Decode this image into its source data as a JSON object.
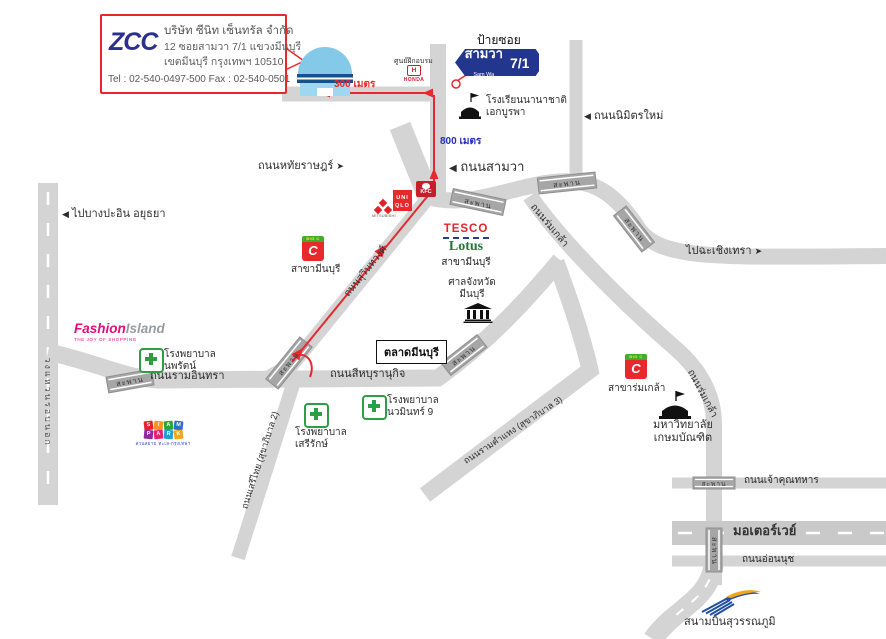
{
  "company_box": {
    "logo": "ZCC",
    "name": "บริษัท ซีนิท เซ็นทรัล จำกัด",
    "address1": "12 ซอยสามวา 7/1 แขวงมีนบุรี",
    "address2": "เขตมีนบุรี กรุงเทพฯ 10510",
    "contact": "Tel : 02-540-0497-500 Fax : 02-540-0501"
  },
  "soi_sign": {
    "caption": "ป้ายซอย",
    "name": "สามวา",
    "name_en": "Sam Wa",
    "number": "7/1"
  },
  "route": {
    "d300": "300 เมตร",
    "d800": "800 เมตร"
  },
  "icons": {
    "arrow_left": "◀",
    "arrow_right": "➤"
  },
  "roads": {
    "sam_wa": "ถนนสามวา",
    "nimit_mai": "ถนนนิมิตรใหม่",
    "hathai_rat": "ถนนหทัยราษฎร์",
    "ram_inthra": "ถนนรามอินทรา",
    "sihaburanukit": "ถนนสีหบุรานุกิจ",
    "suwinthawong": "ถนนสุวินทวงศ์",
    "rom_klao": "ถนนร่มเกล้า",
    "seri_thai": "ถนนเสรีไทย (สุขาภิบาล 2)",
    "ramkhamhaeng": "ถนนรามคำแหง (สุขาภิบาล 3)",
    "ring_road": "วงแหวนรอบนอก",
    "motorway": "มอเตอร์เวย์",
    "chao_khun_thahan": "ถนนเจ้าคุณทหาร",
    "on_nut": "ถนนอ่อนนุช",
    "saphan": "สะพาน",
    "to_bang_pa_in": "ไปบางปะอิน อยุธยา",
    "to_chachoengsao": "ไปฉะเชิงเทรา"
  },
  "places": {
    "honda": {
      "caption": "ศูนย์ฝึกอบรม",
      "logo": "HONDA",
      "h": "H"
    },
    "school": {
      "line1": "โรงเรียนนานาชาติ",
      "line2": "เอกบูรพา"
    },
    "tesco": {
      "brand1": "TESCO",
      "brand2": "Lotus",
      "branch": "สาขามีนบุรี"
    },
    "bigc_minburi": {
      "top": "BIG C",
      "letter": "C",
      "branch": "สาขามีนบุรี"
    },
    "bigc_romklao": {
      "top": "BIG C",
      "letter": "C",
      "branch": "สาขาร่มเกล้า"
    },
    "court": {
      "line1": "ศาลจังหวัด",
      "line2": "มีนบุรี"
    },
    "market": {
      "name": "ตลาดมีนบุรี"
    },
    "fashion_island": {
      "part1": "Fashion",
      "part2": "Island",
      "tagline": "THE JOY OF SHOPPING"
    },
    "hospital_nopparat": {
      "line1": "โรงพยาบาล",
      "line2": "นพรัตน์"
    },
    "hospital_navamin": {
      "line1": "โรงพยาบาล",
      "line2": "นวมินทร์ 9"
    },
    "hospital_serirak": {
      "line1": "โรงพยาบาล",
      "line2": "เสรีรักษ์"
    },
    "siam_park": {
      "blocks": [
        "S",
        "I",
        "A",
        "M",
        "P",
        "A",
        "R",
        "K"
      ],
      "tagline": "สวนสยาม ทะเล-กรุงเทพฯ"
    },
    "university": {
      "line1": "มหาวิทยาลัย",
      "line2": "เกษมบัณฑิต"
    },
    "airport": {
      "name": "สนามบินสุวรรณภูมิ"
    },
    "uniqlo": {
      "line1": "UNI",
      "line2": "QLO"
    },
    "kfc": {
      "name": "KFC"
    },
    "mitsubishi": {
      "name": "MITSUBISHI"
    }
  }
}
